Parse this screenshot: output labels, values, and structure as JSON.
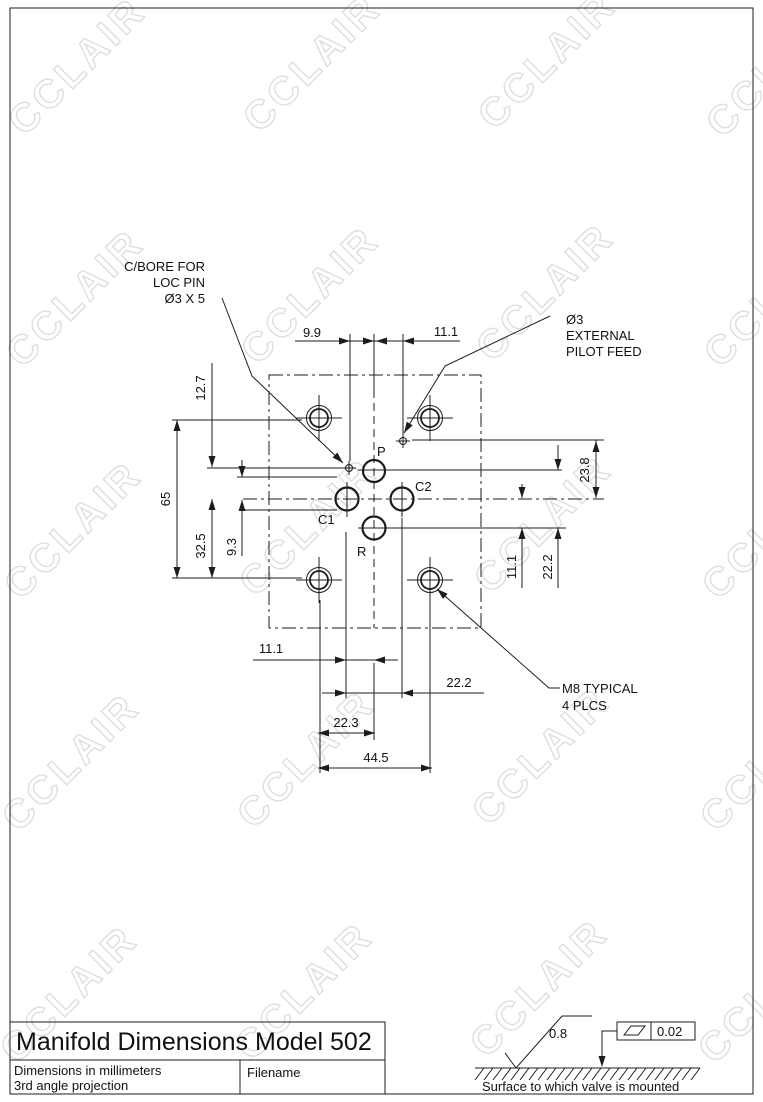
{
  "watermark": "CCLAIR",
  "drawing": {
    "ports": {
      "p": "P",
      "c1": "C1",
      "c2": "C2",
      "r": "R"
    },
    "annotations": {
      "cbore": [
        "C/BORE FOR",
        "LOC PIN",
        "Ø3 X 5"
      ],
      "pilot": [
        "Ø3",
        "EXTERNAL",
        "PILOT FEED"
      ],
      "m8": [
        "M8 TYPICAL",
        "4 PLCS"
      ]
    },
    "dims": {
      "top_9_9": "9.9",
      "top_11_1": "11.1",
      "left_12_7": "12.7",
      "left_65": "65",
      "left_32_5": "32.5",
      "left_9_3": "9.3",
      "right_23_8": "23.8",
      "right_11_1": "11.1",
      "right_22_2": "22.2",
      "bottom_11_1": "11.1",
      "bottom_22_2": "22.2",
      "bottom_22_3": "22.3",
      "bottom_44_5": "44.5"
    }
  },
  "title_block": {
    "title": "Manifold Dimensions Model 502",
    "note_line1": "Dimensions in millimeters",
    "note_line2": "3rd angle projection",
    "filename_label": "Filename"
  },
  "finish_note": {
    "roughness": "0.8",
    "flatness": "0.02",
    "surface_text": "Surface to which valve is mounted"
  }
}
